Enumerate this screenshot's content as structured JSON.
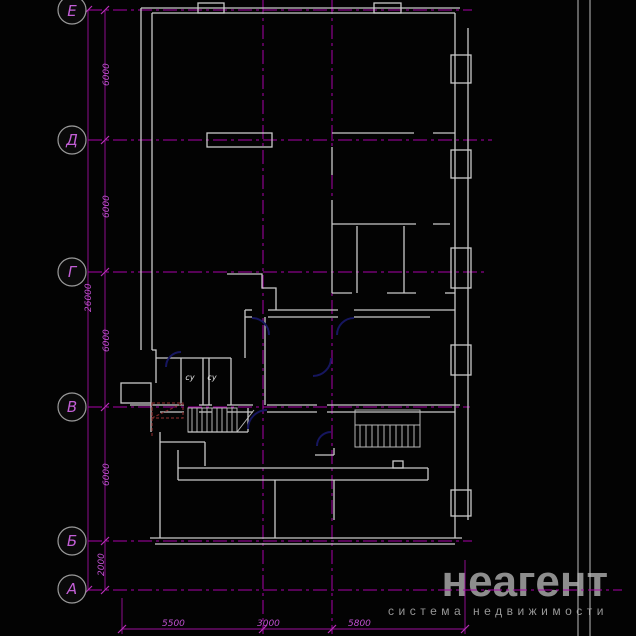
{
  "drawing": {
    "title": "floor-plan",
    "axes": [
      {
        "label": "Е"
      },
      {
        "label": "Д"
      },
      {
        "label": "Г"
      },
      {
        "label": "В"
      },
      {
        "label": "Б"
      },
      {
        "label": "А"
      }
    ],
    "dims_left": [
      "6000",
      "6000",
      "6000",
      "6000",
      "2000"
    ],
    "dim_total": "26000",
    "dims_bottom": [
      "5500",
      "3000",
      "5800"
    ],
    "room_labels": [
      "су",
      "су"
    ],
    "colors": {
      "background": "#030303",
      "walls": "#c9c9c9",
      "grid": "#a800a8",
      "dim_text": "#c050d0",
      "door_arc": "#16165f",
      "demolition_red": "#7c2828",
      "watermark": "#8d8d8d"
    }
  },
  "watermark": {
    "brand": "неагент",
    "tagline": "система недвижимости"
  }
}
